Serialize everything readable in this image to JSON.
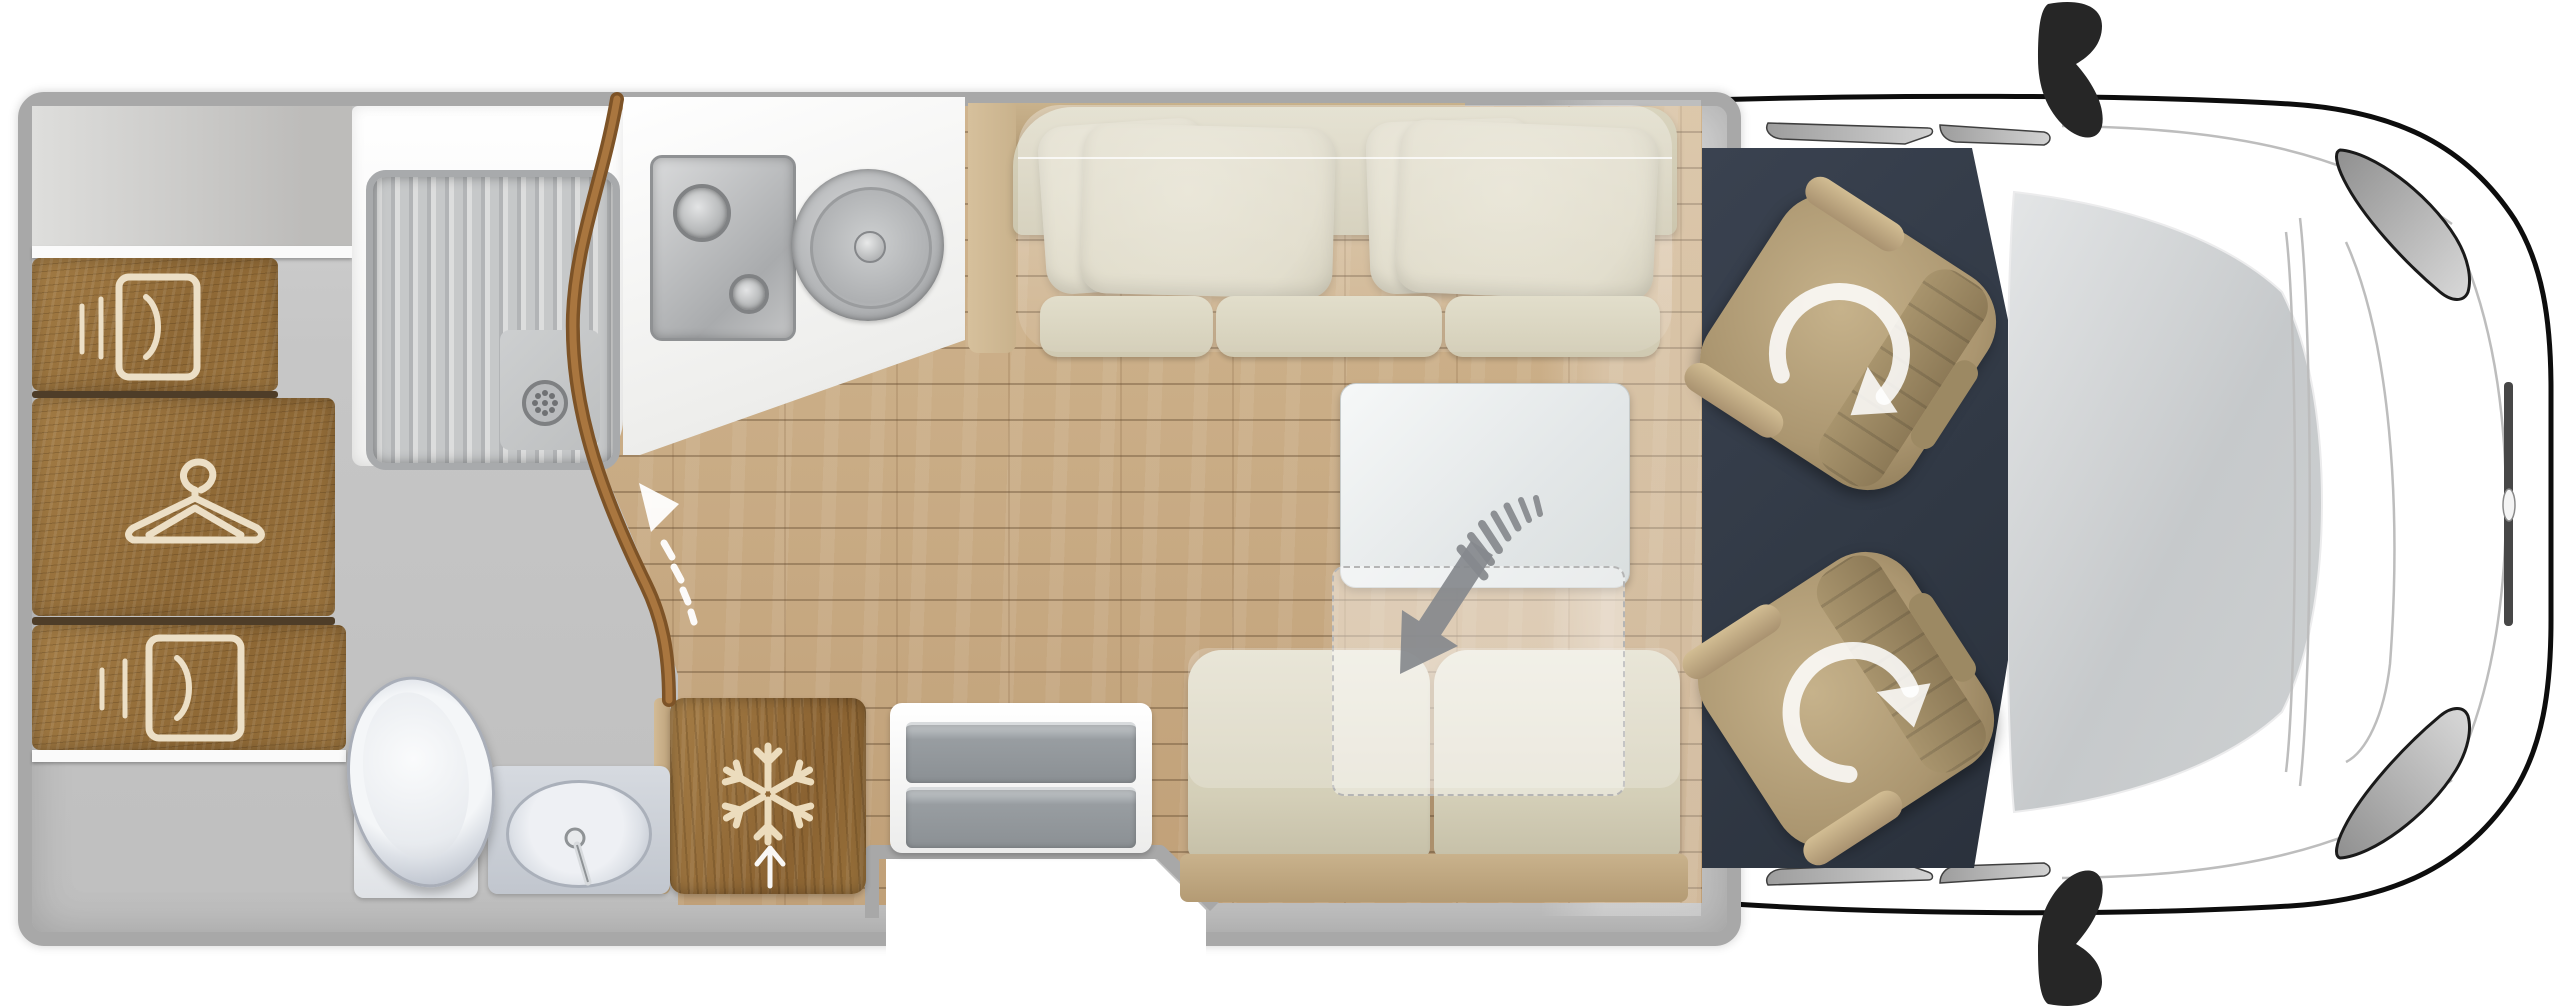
{
  "page": {
    "background": "#ffffff",
    "kind": "motorhome-floorplan-top-view"
  },
  "theme": {
    "page": "#ffffff",
    "wall": "#a8a8a8",
    "floor-gray": "#c6c6c6",
    "wood": "#8e6835",
    "wood-seam": "#4e3d28",
    "cream": "#ecdfc6",
    "plank": "#d0b58f",
    "plank-dark": "#c0a078",
    "slate": "#313945",
    "beige": "#d9d4be",
    "beige-light": "#e3dfcd",
    "tan": "#c9b28c",
    "seat-tan": "#ab9670",
    "silver": "#c3c5c7",
    "drawer-gray": "#8b9094",
    "arrow-gray": "#86898d",
    "outline": "#0d0d0d"
  },
  "icons": {
    "list": [
      {
        "name": "hanger-icon"
      },
      {
        "name": "cabinet-door-icon"
      },
      {
        "name": "cabinet-door-small-icon"
      },
      {
        "name": "snowflake-icon"
      },
      {
        "name": "door-swing-arrow-icon"
      },
      {
        "name": "entry-up-arrow-icon"
      },
      {
        "name": "table-lower-arrow-icon"
      },
      {
        "name": "seat-rotation-arrow-icon"
      },
      {
        "name": "drain-icon"
      },
      {
        "name": "faucet-icon"
      }
    ]
  },
  "zones": {
    "names": [
      "rear-wardrobe",
      "shower-cubicle",
      "bathroom",
      "kitchen-galley",
      "refrigerator",
      "lounge-sofa",
      "dining-table",
      "bench-seat",
      "entry-step",
      "cab",
      "driver-seat",
      "passenger-seat"
    ]
  }
}
